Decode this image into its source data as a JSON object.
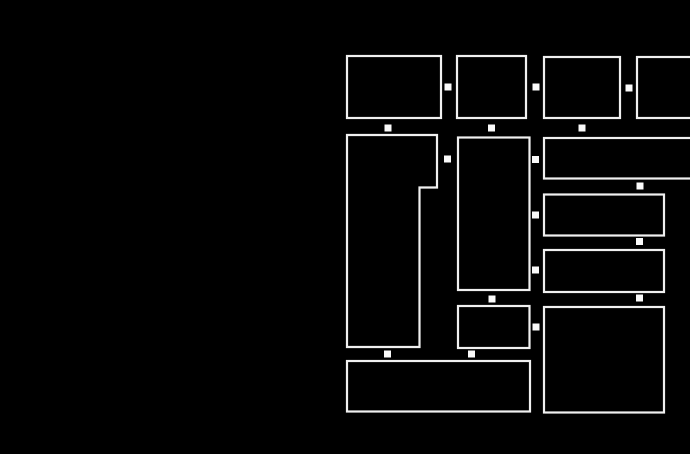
{
  "canvas": {
    "width": 690,
    "height": 454,
    "background": "#000000"
  },
  "style": {
    "tile_fill": "#000000",
    "tile_stroke": "#f0f0f0",
    "tile_stroke_width": 2.2,
    "handle_fill": "#fafafa",
    "handle_size": 7
  },
  "tiles": [
    {
      "id": "tile-top-row-1",
      "shape": "rect",
      "x": 347,
      "y": 56,
      "w": 94,
      "h": 62
    },
    {
      "id": "tile-top-row-2",
      "shape": "rect",
      "x": 457,
      "y": 56,
      "w": 69,
      "h": 62
    },
    {
      "id": "tile-top-row-3",
      "shape": "rect",
      "x": 544,
      "y": 57,
      "w": 76,
      "h": 61
    },
    {
      "id": "tile-top-row-4-clipped",
      "shape": "rect",
      "x": 637,
      "y": 57,
      "w": 83,
      "h": 61
    },
    {
      "id": "tile-notched-tall",
      "shape": "polygon",
      "points": [
        [
          347,
          135
        ],
        [
          437,
          135
        ],
        [
          437,
          187.5
        ],
        [
          419.5,
          187.5
        ],
        [
          419.5,
          347
        ],
        [
          347,
          347
        ]
      ]
    },
    {
      "id": "tile-mid-column-tall",
      "shape": "rect",
      "x": 458,
      "y": 137.5,
      "w": 71.5,
      "h": 152.5
    },
    {
      "id": "tile-right-wide-1-clipped",
      "shape": "rect",
      "x": 544,
      "y": 138,
      "w": 176,
      "h": 40.5
    },
    {
      "id": "tile-right-wide-2",
      "shape": "rect",
      "x": 544,
      "y": 194.5,
      "w": 120,
      "h": 41
    },
    {
      "id": "tile-right-wide-3",
      "shape": "rect",
      "x": 544,
      "y": 250,
      "w": 120,
      "h": 42
    },
    {
      "id": "tile-right-big",
      "shape": "rect",
      "x": 544,
      "y": 307,
      "w": 120,
      "h": 105.5
    },
    {
      "id": "tile-mid-column-small",
      "shape": "rect",
      "x": 458,
      "y": 306,
      "w": 71.5,
      "h": 42
    },
    {
      "id": "tile-bottom-wide",
      "shape": "rect",
      "x": 347,
      "y": 361,
      "w": 183,
      "h": 50.5
    }
  ],
  "handles": [
    {
      "cx": 448,
      "cy": 87
    },
    {
      "cx": 536,
      "cy": 87
    },
    {
      "cx": 629,
      "cy": 88
    },
    {
      "cx": 388,
      "cy": 128
    },
    {
      "cx": 491.5,
      "cy": 128
    },
    {
      "cx": 582,
      "cy": 128
    },
    {
      "cx": 447.5,
      "cy": 159
    },
    {
      "cx": 535.5,
      "cy": 159.5
    },
    {
      "cx": 535.5,
      "cy": 215
    },
    {
      "cx": 535.5,
      "cy": 270
    },
    {
      "cx": 640,
      "cy": 186
    },
    {
      "cx": 639.5,
      "cy": 241.5
    },
    {
      "cx": 639.5,
      "cy": 298
    },
    {
      "cx": 536,
      "cy": 327
    },
    {
      "cx": 492,
      "cy": 299
    },
    {
      "cx": 387.5,
      "cy": 354
    },
    {
      "cx": 471.5,
      "cy": 354
    }
  ]
}
